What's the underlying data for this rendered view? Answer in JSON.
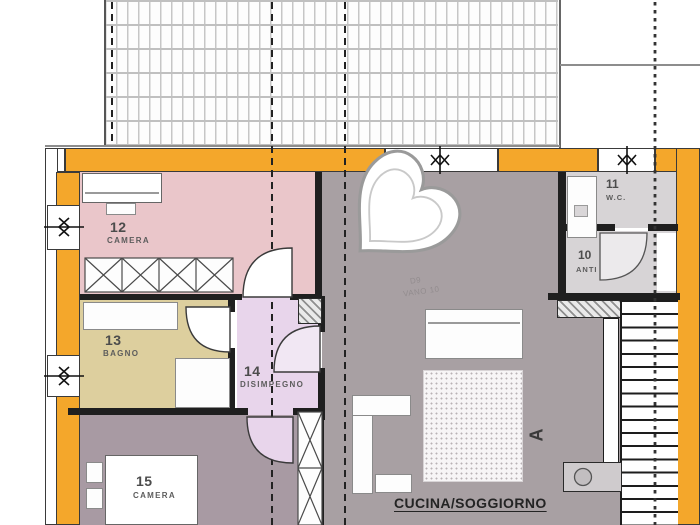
{
  "palette": {
    "wall_orange": "#f4a72b",
    "room12_pink": "#eac6ca",
    "room13_tan": "#ddcf9e",
    "room14_lilac": "#e8d5eb",
    "room15_mauve": "#a89aa3",
    "living_gray": "#a8a0a3",
    "service_gray": "#d7d4d6",
    "line_dark": "#1f1f1f"
  },
  "rooms": [
    {
      "number": "12",
      "name": "CAMERA"
    },
    {
      "number": "13",
      "name": "BAGNO"
    },
    {
      "number": "14",
      "name": "DISIMPEGNO"
    },
    {
      "number": "15",
      "name": "CAMERA"
    },
    {
      "number": "11",
      "name": "W.C."
    },
    {
      "number": "10",
      "name": "ANTI"
    }
  ],
  "labels": {
    "living_room": "CUCINA/SOGGIORNO",
    "section_marker": "A",
    "faint_note_line1": "D9",
    "faint_note_line2": "VANO 10"
  }
}
